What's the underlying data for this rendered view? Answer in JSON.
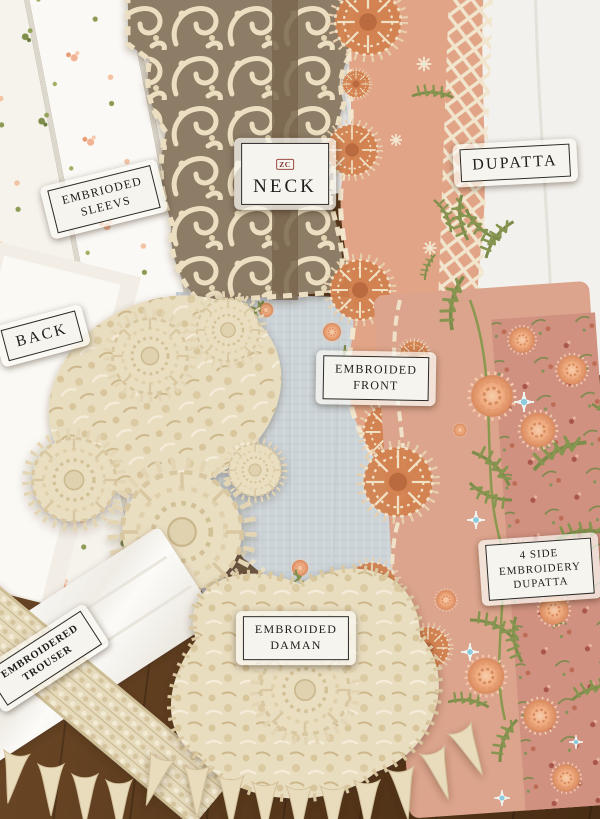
{
  "labels": {
    "sleeves": {
      "lines": [
        "EMBRIODED",
        "SLEEVS"
      ]
    },
    "neck": {
      "monogram": "ZC",
      "text": "NECK"
    },
    "dupatta": {
      "text": "DUPATTA"
    },
    "back": {
      "text": "BACK"
    },
    "front": {
      "lines": [
        "EMBROIDED",
        "FRONT"
      ]
    },
    "daman": {
      "lines": [
        "EMBROIDED",
        "DAMAN"
      ]
    },
    "trouser": {
      "lines": [
        "EMBROIDERED",
        "TROUSER"
      ]
    },
    "side_dupatta": {
      "lines": [
        "4 SIDE",
        "EMBROIDERY",
        "DUPATTA"
      ]
    }
  },
  "palette": {
    "wood_floor": "#5e3d20",
    "white_fabric": "#f7f4ee",
    "cream_lace": "#e9ddc0",
    "lace_ground_brown": "#8d7c66",
    "peach_dupatta": "#e2a486",
    "dusty_rose_print": "#d09180",
    "pale_blue_front": "#ccd4d8",
    "olive_green_embroidery": "#7d8c4a",
    "coral_fan_motif": "#d2814e",
    "sky_blue_accent": "#8ccbdc",
    "label_paper": "#f6f4ee",
    "label_ink": "#1f1d1a"
  }
}
